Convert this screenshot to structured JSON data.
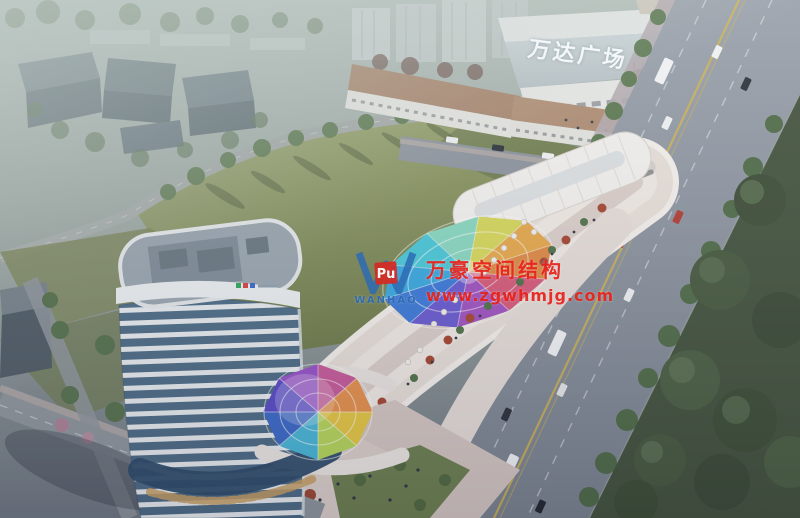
{
  "image": {
    "title": "Aerial dusk rendering of a commercial complex beside Wanda Plaza",
    "mall_sign": "万达广场",
    "watermark": {
      "brand_cn": "万豪空间结构",
      "website": "www.zgwhmjg.com",
      "logo_text": "WANHAO",
      "logo_glyph": "Pu",
      "text_color": "#e8231c",
      "logo_blue": "#2e6bb4",
      "logo_red": "#d42a24"
    },
    "palette": {
      "haze": "#aebab4",
      "field_green": "#86925c",
      "road_grey": "#8a919b",
      "park_green": "#42513b",
      "building_white": "#ece5df",
      "tower_glass_blue": "#4c6a85",
      "mall_roof_tan": "#ab8870",
      "canopy_rainbow": [
        "#e08840",
        "#d85878",
        "#a050c0",
        "#6858d0",
        "#3a78d8",
        "#38a8e0",
        "#48c8d8",
        "#88d8c0",
        "#d8d858",
        "#e8a848"
      ]
    }
  }
}
